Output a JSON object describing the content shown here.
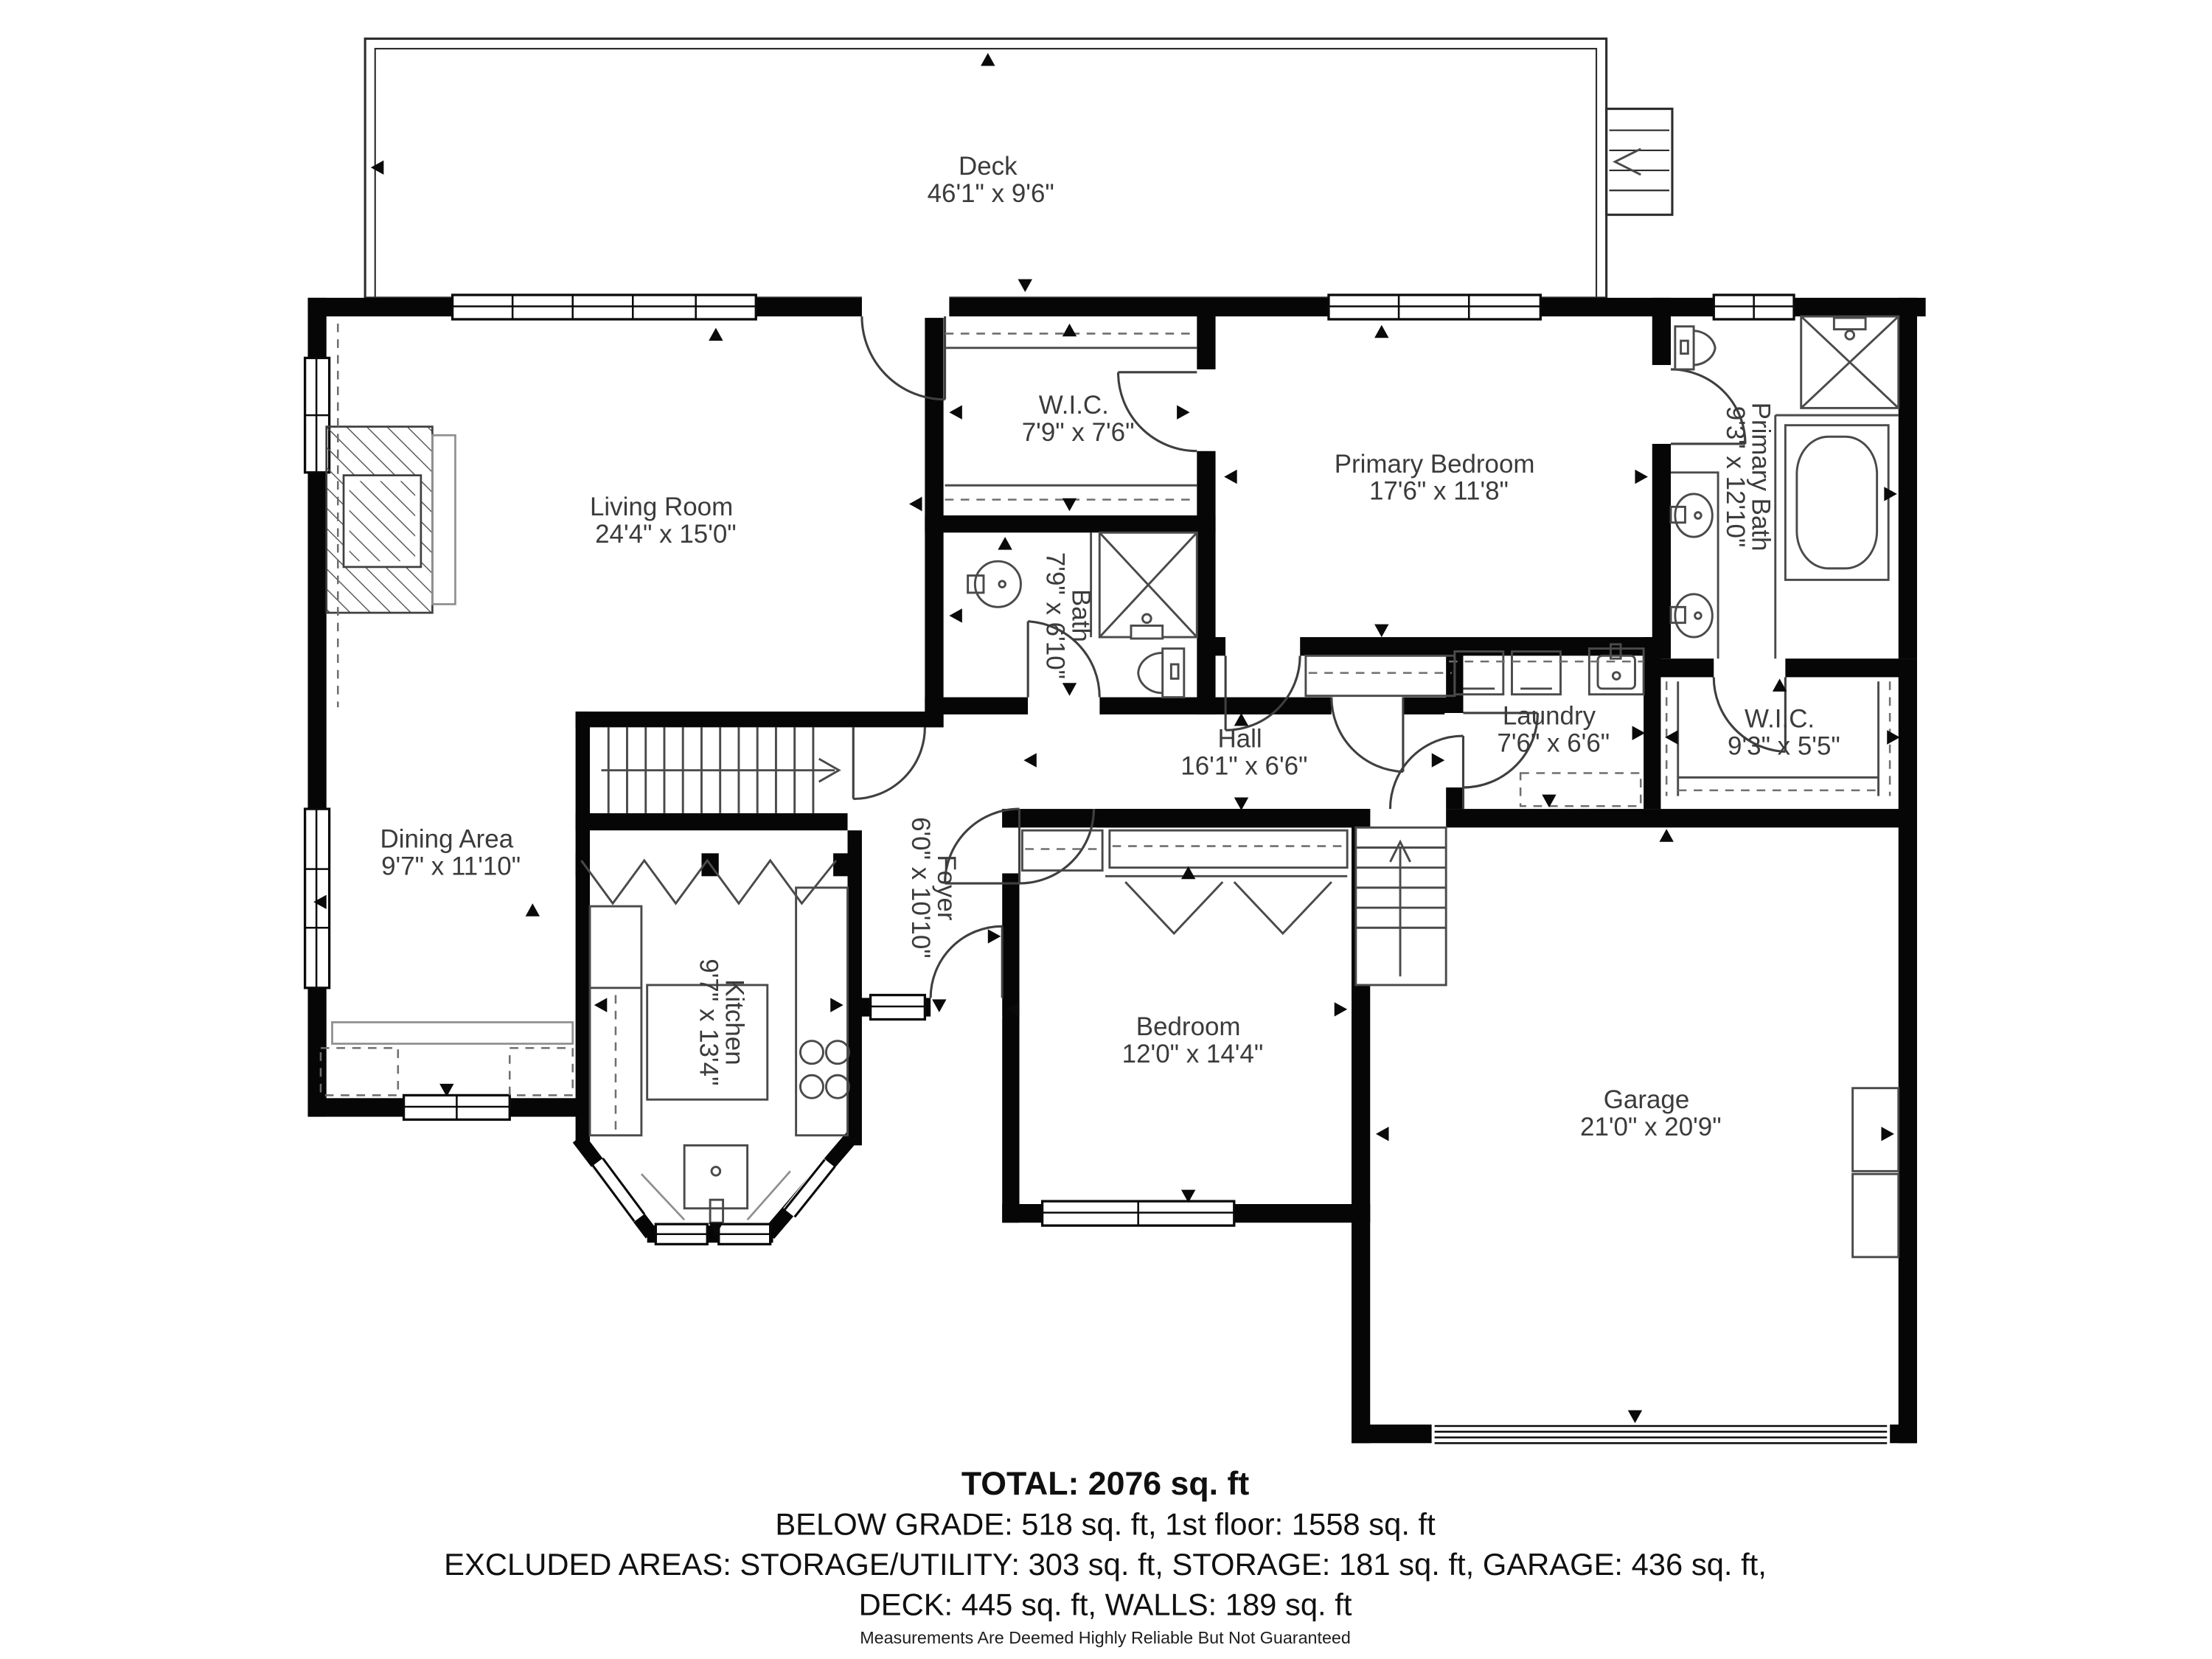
{
  "plan": {
    "rooms": [
      {
        "id": "deck",
        "name": "Deck",
        "dims": "46'1\" x 9'6\""
      },
      {
        "id": "living-room",
        "name": "Living Room",
        "dims": "24'4\" x 15'0\""
      },
      {
        "id": "wic-primary-small",
        "name": "W.I.C.",
        "dims": "7'9\" x 7'6\""
      },
      {
        "id": "primary-bedroom",
        "name": "Primary Bedroom",
        "dims": "17'6\" x 11'8\""
      },
      {
        "id": "primary-bath",
        "name": "Primary Bath",
        "dims": "9'3\" x 12'10\""
      },
      {
        "id": "bath",
        "name": "Bath",
        "dims": "7'9\" x 6'10\""
      },
      {
        "id": "hall",
        "name": "Hall",
        "dims": "16'1\" x 6'6\""
      },
      {
        "id": "laundry",
        "name": "Laundry",
        "dims": "7'6\" x 6'6\""
      },
      {
        "id": "wic-2",
        "name": "W.I.C.",
        "dims": "9'3\" x 5'5\""
      },
      {
        "id": "dining-area",
        "name": "Dining Area",
        "dims": "9'7\" x 11'10\""
      },
      {
        "id": "foyer",
        "name": "Foyer",
        "dims": "6'0\" x 10'10\""
      },
      {
        "id": "kitchen",
        "name": "Kitchen",
        "dims": "9'7\" x 13'4\""
      },
      {
        "id": "bedroom",
        "name": "Bedroom",
        "dims": "12'0\" x 14'4\""
      },
      {
        "id": "garage",
        "name": "Garage",
        "dims": "21'0\" x 20'9\""
      }
    ]
  },
  "summary": {
    "total": "TOTAL: 2076 sq. ft",
    "line2": "BELOW GRADE: 518 sq. ft, 1st floor: 1558 sq. ft",
    "line3": "EXCLUDED AREAS: STORAGE/UTILITY: 303 sq. ft, STORAGE: 181 sq. ft, GARAGE: 436 sq. ft,",
    "line4": "DECK: 445 sq. ft, WALLS: 189 sq. ft",
    "disclaimer": "Measurements Are Deemed Highly Reliable But Not Guaranteed"
  }
}
